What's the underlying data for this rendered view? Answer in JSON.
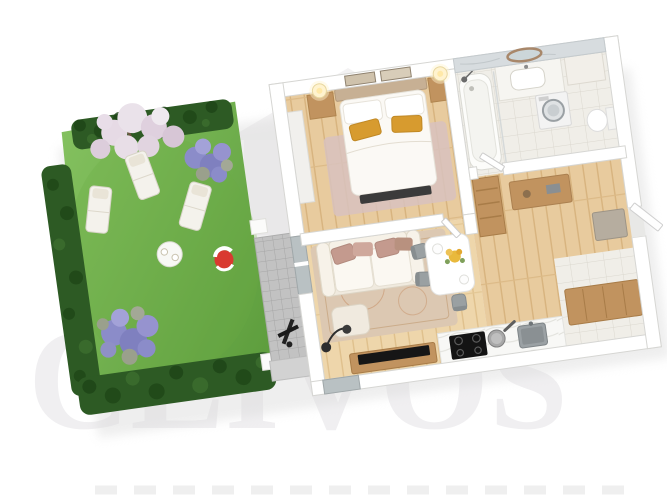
{
  "watermark": {
    "text": "CLIVOS",
    "text_color": "#f0eff1",
    "logo_color": "#f3f2f3",
    "logo_body_color": "#f6f5f6"
  },
  "colors": {
    "background": "#ffffff",
    "grass": "#6fb24c",
    "hedge": "#2d5a24",
    "hedge_dark": "#1d4316",
    "lavender": "#8b8cc9",
    "blossom": "#e6dae5",
    "wood_floor": "#e8cb9e",
    "wood_floor_light": "#eed6ab",
    "terrace_paver": "#c2c2c2",
    "wall": "#ffffff",
    "wall_edge": "#d6d6d3",
    "glass": "#b9c1c3",
    "sofa_cream": "#f0eadf",
    "pillow_rose": "#c49a8e",
    "pillow_mustard": "#d79b2f",
    "furniture_wood": "#c1935f",
    "rug_living": "#dcc8b2",
    "rug_bedroom": "#d8c2be",
    "tv_black": "#161616",
    "appliance_black": "#141414",
    "sink_grey": "#9ba1a4",
    "ball_red": "#d93a30",
    "marble_wall": "#d7dcdf",
    "bath_tile": "#f0eee8"
  },
  "scene": {
    "type": "3d-floor-plan-render",
    "areas": [
      {
        "name": "garden",
        "items": [
          "lawn",
          "hedges",
          "blossom-tree",
          "lavender-bushes",
          "sun-loungers",
          "garden-table",
          "beach-ball"
        ]
      },
      {
        "name": "terrace",
        "items": [
          "stone-pavers",
          "step",
          "dark-floor-lamp"
        ]
      },
      {
        "name": "bedroom",
        "items": [
          "double-bed",
          "mustard-pillows",
          "nightstands",
          "wall-sconces",
          "wall-pictures",
          "wardrobe",
          "rug",
          "bench"
        ]
      },
      {
        "name": "bathroom",
        "items": [
          "bathtub",
          "shower",
          "vanity-sink",
          "round-mirror",
          "washing-machine",
          "toilet"
        ]
      },
      {
        "name": "hallway",
        "items": [
          "ladder-shelf",
          "console",
          "storage-bench",
          "doormat",
          "entrance-door"
        ]
      },
      {
        "name": "living-room",
        "items": [
          "sofa",
          "rose-pillows",
          "pouf",
          "rug",
          "floor-lamp",
          "tv-console",
          "tv"
        ]
      },
      {
        "name": "kitchen-dining",
        "items": [
          "dining-table",
          "chairs",
          "flowers",
          "marble-counter",
          "induction-hob",
          "pan",
          "sink"
        ]
      }
    ]
  }
}
